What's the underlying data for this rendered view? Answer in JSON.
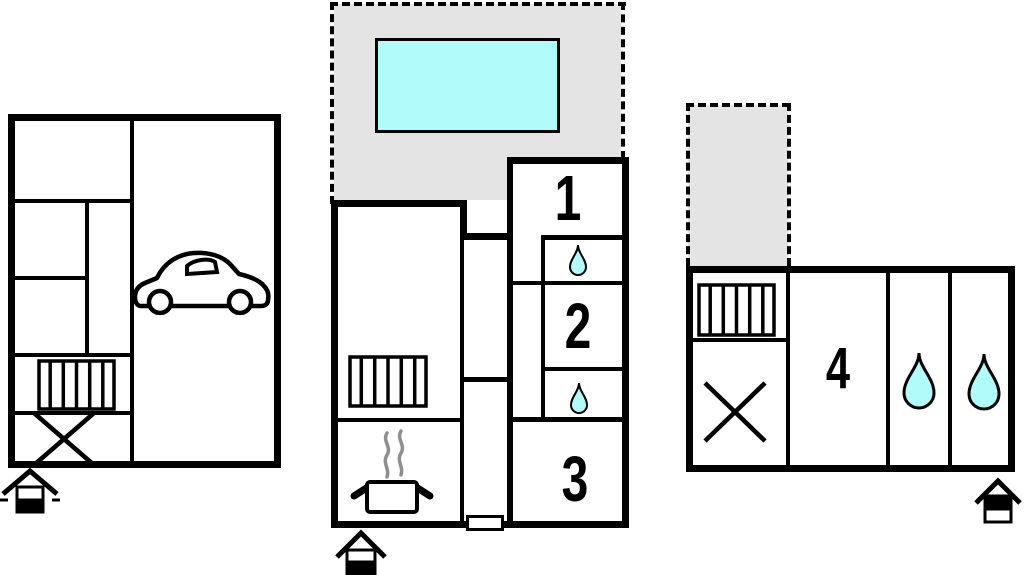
{
  "plan": {
    "rooms": [
      {
        "id": "room-1",
        "label": "1"
      },
      {
        "id": "room-2",
        "label": "2"
      },
      {
        "id": "room-3",
        "label": "3"
      },
      {
        "id": "room-4",
        "label": "4"
      }
    ],
    "colors": {
      "wall": "#000000",
      "water": "#b2fbfb",
      "terrace": "#e4e4e4",
      "steam": "#8f8f8f",
      "background": "#ffffff"
    }
  }
}
